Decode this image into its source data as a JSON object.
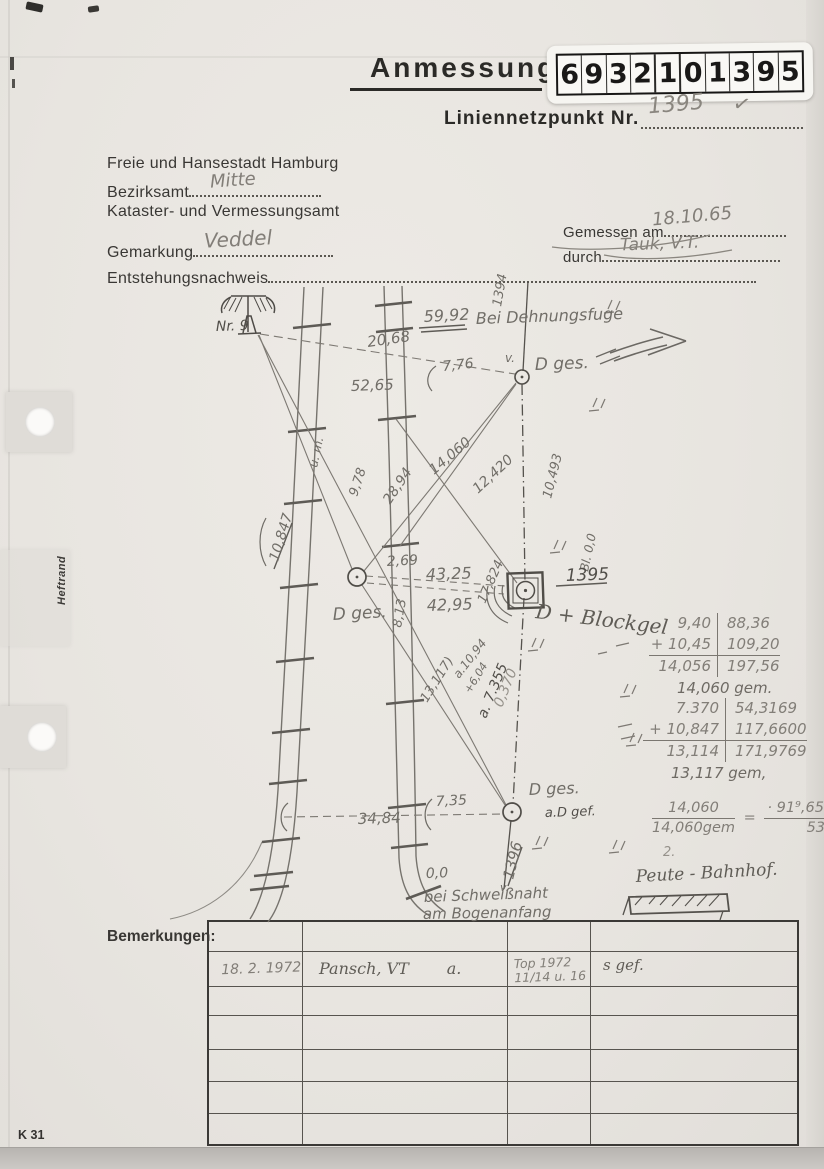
{
  "header": {
    "title": "Anmessung",
    "stamp_digits": [
      "6",
      "9",
      "3",
      "2",
      "1",
      "0",
      "1",
      "3",
      "9",
      "5"
    ],
    "point_label": "Liniennetzpunkt Nr.",
    "point_value": "1395",
    "point_check": "✓"
  },
  "address": {
    "city": "Freie und Hansestadt Hamburg",
    "bezirksamt_label": "Bezirksamt",
    "bezirksamt_value": "Mitte",
    "amt": "Kataster- und Vermessungsamt",
    "gemarkung_label": "Gemarkung",
    "gemarkung_value": "Veddel",
    "entstehung_label": "Entstehungsnachweis"
  },
  "measurement": {
    "gemessen_label": "Gemessen am",
    "gemessen_value": "18.10.65",
    "durch_label": "durch",
    "durch_value": "Tauk, V.T."
  },
  "sketch": {
    "annotations": [
      {
        "t": "Nr. 9",
        "x": 216,
        "y": 331,
        "r": -2,
        "s": 14,
        "c": "d"
      },
      {
        "t": "59,92",
        "x": 424,
        "y": 322,
        "r": -3,
        "s": 16,
        "c": "n"
      },
      {
        "t": "Bei Dehnungsfuge",
        "x": 476,
        "y": 324,
        "r": -2,
        "s": 16,
        "c": "n"
      },
      {
        "t": "20,68",
        "x": 368,
        "y": 347,
        "r": -8,
        "s": 15,
        "c": "n"
      },
      {
        "t": "7,76",
        "x": 443,
        "y": 371,
        "r": -6,
        "s": 14,
        "c": "n"
      },
      {
        "t": "v.",
        "x": 505,
        "y": 362,
        "r": 0,
        "s": 12,
        "c": "n"
      },
      {
        "t": "1394",
        "x": 501,
        "y": 307,
        "r": -80,
        "s": 13,
        "c": "n"
      },
      {
        "t": "D ges.",
        "x": 535,
        "y": 370,
        "r": -2,
        "s": 17,
        "c": "n"
      },
      {
        "t": "52,65",
        "x": 351,
        "y": 391,
        "r": -2,
        "s": 15,
        "c": "n"
      },
      {
        "t": "u. m.",
        "x": 317,
        "y": 468,
        "r": -78,
        "s": 12,
        "c": "n"
      },
      {
        "t": "9,78",
        "x": 357,
        "y": 497,
        "r": -72,
        "s": 13,
        "c": "n"
      },
      {
        "t": "28,94",
        "x": 390,
        "y": 505,
        "r": -56,
        "s": 14,
        "c": "n"
      },
      {
        "t": "14,060",
        "x": 434,
        "y": 475,
        "r": -40,
        "s": 14,
        "c": "n"
      },
      {
        "t": "12,420",
        "x": 478,
        "y": 494,
        "r": -43,
        "s": 14,
        "c": "n"
      },
      {
        "t": "10,493",
        "x": 551,
        "y": 499,
        "r": -76,
        "s": 13,
        "c": "n"
      },
      {
        "t": "Bl. 0,0",
        "x": 588,
        "y": 572,
        "r": -78,
        "s": 12,
        "c": "n"
      },
      {
        "t": "10,847",
        "x": 278,
        "y": 562,
        "r": -73,
        "s": 14,
        "c": "n"
      },
      {
        "t": "2,69",
        "x": 387,
        "y": 566,
        "r": -3,
        "s": 14,
        "c": "n"
      },
      {
        "t": "43,25",
        "x": 426,
        "y": 580,
        "r": -2,
        "s": 16,
        "c": "n"
      },
      {
        "t": "42,95",
        "x": 427,
        "y": 611,
        "r": -2,
        "s": 16,
        "c": "n"
      },
      {
        "t": "D ges.",
        "x": 333,
        "y": 620,
        "r": -3,
        "s": 17,
        "c": "n"
      },
      {
        "t": "8,13",
        "x": 401,
        "y": 628,
        "r": -80,
        "s": 13,
        "c": "n"
      },
      {
        "t": "1395",
        "x": 566,
        "y": 581,
        "r": -2,
        "s": 17,
        "c": "d"
      },
      {
        "t": "D + Blockgel",
        "x": 535,
        "y": 618,
        "r": 7,
        "s": 20,
        "c": "s"
      },
      {
        "t": "17,824",
        "x": 485,
        "y": 604,
        "r": -66,
        "s": 13,
        "c": "n"
      },
      {
        "t": "13,117)",
        "x": 427,
        "y": 703,
        "r": -58,
        "s": 13,
        "c": "n"
      },
      {
        "t": "a.10,94",
        "x": 459,
        "y": 679,
        "r": -52,
        "s": 12,
        "c": "n"
      },
      {
        "t": "+6,04",
        "x": 470,
        "y": 694,
        "r": -58,
        "s": 11,
        "c": "n"
      },
      {
        "t": "a. 7.355",
        "x": 486,
        "y": 719,
        "r": -68,
        "s": 14,
        "c": "d"
      },
      {
        "t": "0,370",
        "x": 502,
        "y": 708,
        "r": -68,
        "s": 14,
        "c": "f"
      },
      {
        "t": "D ges.",
        "x": 529,
        "y": 795,
        "r": -2,
        "s": 16,
        "c": "n"
      },
      {
        "t": "a.D gef.",
        "x": 545,
        "y": 817,
        "r": -2,
        "s": 13,
        "c": "d"
      },
      {
        "t": "7,35",
        "x": 436,
        "y": 806,
        "r": -3,
        "s": 14,
        "c": "n"
      },
      {
        "t": "34,84",
        "x": 358,
        "y": 824,
        "r": -2,
        "s": 15,
        "c": "n"
      },
      {
        "t": "1396",
        "x": 513,
        "y": 880,
        "r": -76,
        "s": 15,
        "c": "n"
      },
      {
        "t": "v.",
        "x": 500,
        "y": 891,
        "r": 0,
        "s": 11,
        "c": "n"
      },
      {
        "t": "0,0",
        "x": 426,
        "y": 878,
        "r": -2,
        "s": 14,
        "c": "n"
      },
      {
        "t": "bei Schweißnaht",
        "x": 424,
        "y": 902,
        "r": -2,
        "s": 15,
        "c": "n"
      },
      {
        "t": "am Bogenanfang",
        "x": 423,
        "y": 919,
        "r": -1,
        "s": 15,
        "c": "n"
      },
      {
        "t": "Peute - Bahnhof.",
        "x": 636,
        "y": 882,
        "r": -3,
        "s": 17,
        "c": "s"
      },
      {
        "t": "2.",
        "x": 663,
        "y": 856,
        "r": 0,
        "s": 13,
        "c": "f"
      }
    ]
  },
  "calculations": {
    "block1": {
      "rows": [
        [
          "9,40",
          "88,36"
        ],
        [
          "+ 10,45",
          "109,20"
        ],
        [
          "14,056",
          "197,56"
        ]
      ],
      "result": "14,060 gem."
    },
    "block2": {
      "rows": [
        [
          "7.370",
          "54,3169"
        ],
        [
          "+ 10,847",
          "117,6600"
        ],
        [
          "13,114",
          "171,9769"
        ]
      ],
      "result": "13,117 gem,"
    },
    "formula": {
      "left_top": "14,060",
      "left_bottom": "14,060gem",
      "equals": "=",
      "numerator": "· 91⁹,65  10 · 10,493",
      "denominator": "53⁹,0248"
    }
  },
  "bemerkungen": {
    "label": "Bemerkungen:",
    "entry": {
      "date": "18. 2. 1972",
      "name": "Pansch, VT",
      "name_suffix": "a.",
      "ref_line1": "Top 1972",
      "ref_line2": "11/14 u. 16",
      "note": "s gef."
    }
  },
  "margin": {
    "heftrand": "Heftrand",
    "form_code": "K 31"
  }
}
